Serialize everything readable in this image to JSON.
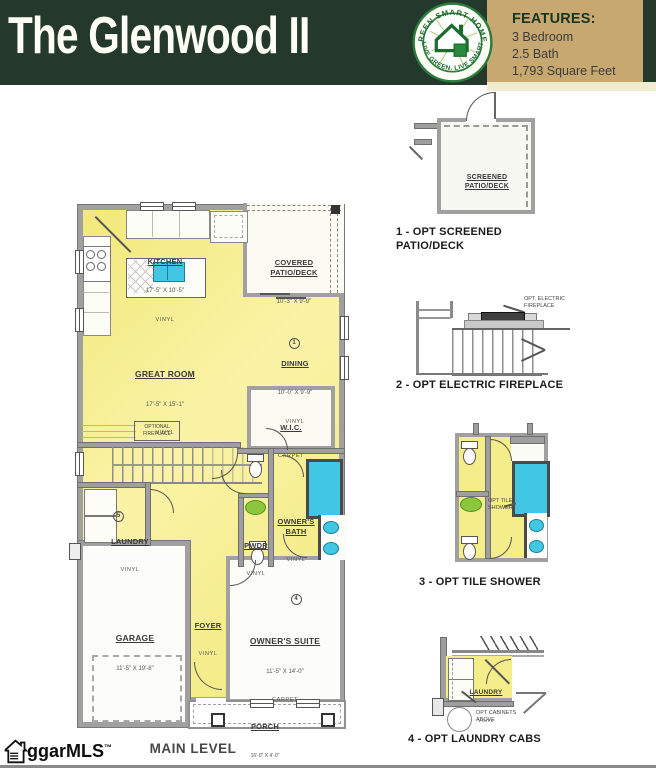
{
  "header": {
    "title": "The Glenwood II",
    "badge": {
      "arc_top": "GREEN SMART HOMES",
      "arc_bottom": "LIVE GREEN. LIVE SMART"
    },
    "features": {
      "heading": "FEATURES:",
      "items": [
        "3 Bedroom",
        "2.5 Bath",
        "1,793 Square Feet"
      ]
    }
  },
  "plan": {
    "level_label": "MAIN LEVEL",
    "rooms": {
      "kitchen": {
        "name": "KITCHEN",
        "dims": "17'-5\" X 10'-5\"",
        "floor": "VINYL"
      },
      "covered_patio": {
        "name": "COVERED\nPATIO/DECK",
        "dims": "10'-3\" X 9'-9\"",
        "option_num": "1"
      },
      "dining": {
        "name": "DINING",
        "dims": "10'-0\" X 9'-9\"",
        "floor": "VINYL"
      },
      "great_room": {
        "name": "GREAT ROOM",
        "dims": "17'-5\" X 15'-1\"",
        "floor": "VINYL"
      },
      "wic": {
        "name": "W.I.C.",
        "floor": "CARPET"
      },
      "optional_fireplace": {
        "label": "OPTIONAL\nFIREPLACE"
      },
      "laundry": {
        "name": "LAUNDRY",
        "floor": "VINYL",
        "option_num": "5"
      },
      "pwdr": {
        "name": "PWDR",
        "floor": "VINYL"
      },
      "owners_bath": {
        "name": "OWNER'S\nBATH",
        "floor": "VINYL",
        "option_num": "4"
      },
      "garage": {
        "name": "GARAGE",
        "dims": "11'-5\" X 19'-8\""
      },
      "foyer": {
        "name": "FOYER",
        "floor": "VINYL"
      },
      "owners_suite": {
        "name": "OWNER'S SUITE",
        "dims": "11'-5\" X 14'-0\"",
        "floor": "CARPET"
      },
      "porch": {
        "name": "PORCH",
        "dims": "16'-0\" X 4'-0\""
      }
    }
  },
  "options": {
    "opt1": {
      "room_label": "SCREENED\nPATIO/DECK",
      "caption": "1 - OPT SCREENED\nPATIO/DECK"
    },
    "opt2": {
      "annotation": "OPT. ELECTRIC\nFIREPLACE",
      "caption": "2 - OPT ELECTRIC FIREPLACE"
    },
    "opt3": {
      "annotation": "OPT TILE-\nSHOWER",
      "caption": "3 - OPT TILE SHOWER"
    },
    "opt4": {
      "room_label": "LAUNDRY",
      "room_floor": "VINYL",
      "annotation": "OPT CABINETS\nABOVE",
      "caption": "4 - OPT LAUNDRY CABS"
    }
  },
  "watermark": {
    "text": "ggarMLS",
    "tm": "™"
  },
  "colors": {
    "header_green": "#24392C",
    "panel_tan": "#C7A870",
    "room_yellow": "#F5EC8A",
    "fixture_cyan": "#41C7E3",
    "sink_green": "#8CC63F"
  }
}
